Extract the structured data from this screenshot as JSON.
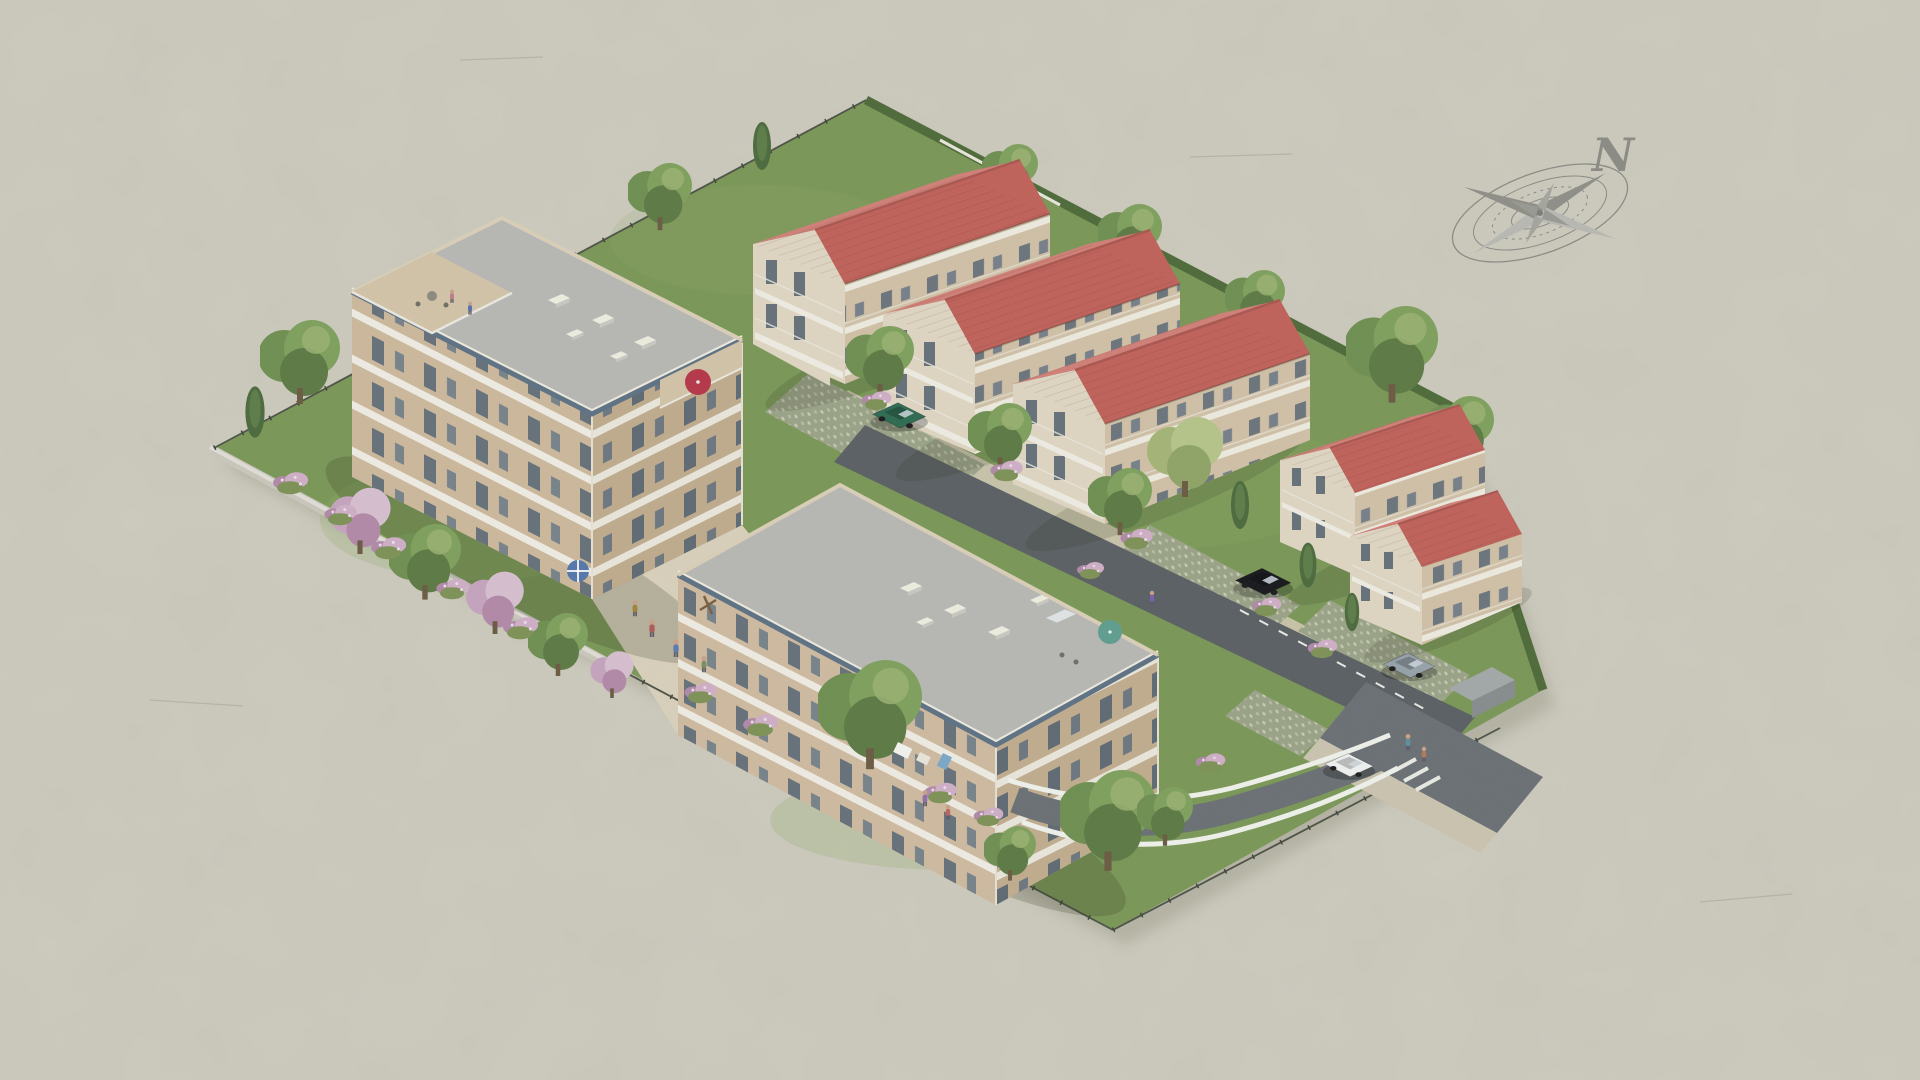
{
  "compass": {
    "label": "N"
  },
  "scene": {
    "type": "aerial-3d-architectural-rendering",
    "buildings": {
      "flat_roof_apartment_blocks": 2,
      "red_roof_intermediate_blocks": 3,
      "red_roof_houses": 2
    },
    "vehicles": [
      "green-hatchback",
      "black-suv",
      "silver-sedan",
      "white-hatchback"
    ],
    "umbrellas": [
      "red",
      "green",
      "blue-white"
    ]
  },
  "palette": {
    "paper": "#d2d1c5",
    "paper_light": "#d9d8cc",
    "grass": "#7a9757",
    "grass_light": "#8fae69",
    "hedge": "#4f6b3a",
    "foliage": "#6f8f52",
    "foliage_light": "#9ab072",
    "foliage_dark": "#46603a",
    "blossom": "#c5a3bd",
    "flower": "#cfaec6",
    "wall_a_sw": "#cbb89c",
    "wall_a_se": "#bfab8e",
    "wall_b_sw": "#cdbaa0",
    "wall_b_se": "#c0ac8f",
    "band_white": "#edebe2",
    "window_dark": "#66717a",
    "flat_roof": "#b7b7b4",
    "roof_fascia": "#5e7284",
    "parapet": "#d9ceb7",
    "terrace": "#d2c3a8",
    "red_roof_light": "#cf8077",
    "red_roof_dark": "#bf625b",
    "red_ridge": "#aa5750",
    "gable_cream": "#ded5c2",
    "red_wall": "#cfc0a6",
    "path": "#cfc8b2",
    "courtyard": "#d8d0bb",
    "asphalt": "#5b6064",
    "asphalt_light": "#6a7074",
    "pavers": "#9aa387",
    "paver_dot": "#c6cab4",
    "boundary_wall": "#c9c6bc",
    "wall_top": "#dfddd5",
    "fence_dark": "#4d5247",
    "picket_light": "#e8e6db",
    "car_green": "#2e6b52",
    "car_black": "#17191d",
    "car_silver": "#97a1ab",
    "car_white": "#eef0f0",
    "umbrella_red": "#b5374a",
    "umbrella_green": "#5f9e8f",
    "parasol_blue": "#5577aa",
    "compass_gray": "#8b8b85",
    "scratch": "#a9a89c"
  }
}
